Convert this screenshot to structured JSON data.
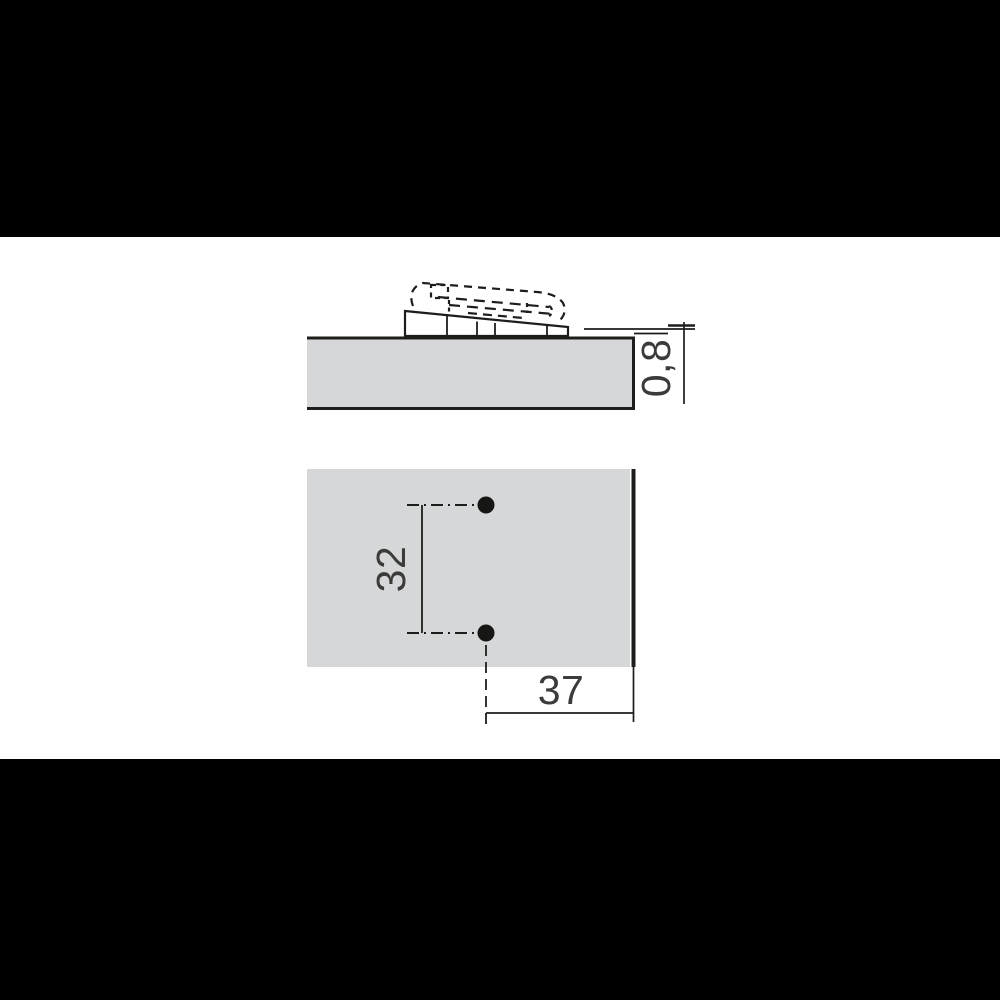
{
  "drawing": {
    "side_view": {
      "thickness_label": "0,8"
    },
    "face_view": {
      "hole_spacing_label": "32",
      "edge_distance_label": "37"
    },
    "colors": {
      "panel_fill": "#d6d7d8",
      "line": "#1d1d1b",
      "text": "#3b3b39",
      "letterbox": "#000000",
      "canvas": "#ffffff"
    }
  }
}
